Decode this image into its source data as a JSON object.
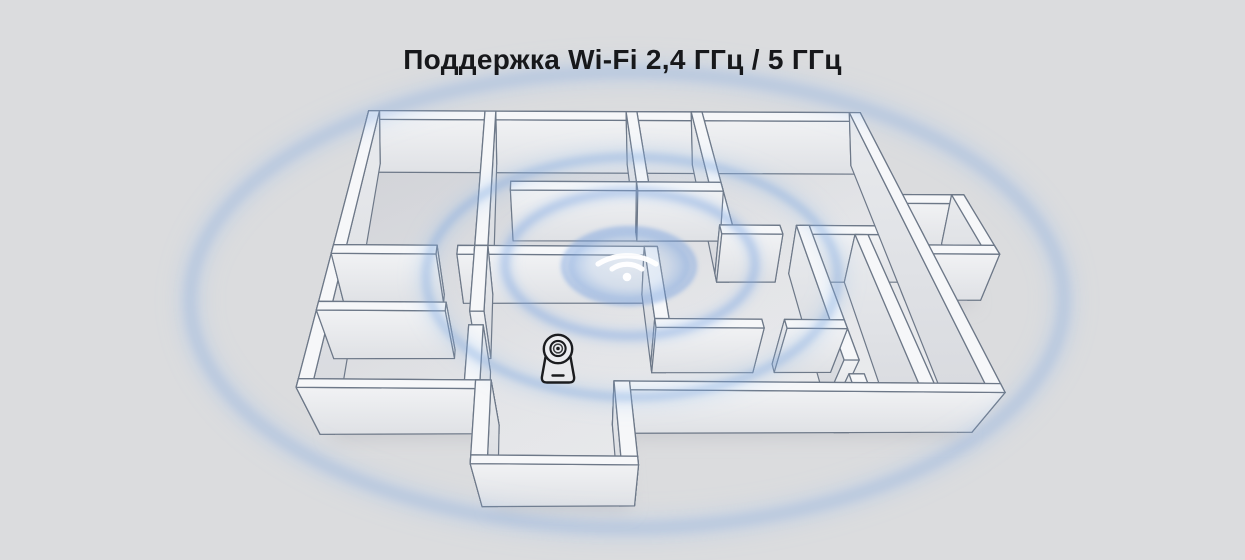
{
  "title": "Поддержка Wi-Fi 2,4 ГГц / 5 ГГц",
  "icons": {
    "wifi": "wifi-icon",
    "camera": "camera-icon"
  },
  "colors": {
    "bg": "#dbdcde",
    "title": "#17181b",
    "wall_stroke": "#6d7888",
    "wall_top": "#f6f7f9",
    "face_hi": "#f1f2f4",
    "face_lo": "#dfe1e5",
    "faced_hi": "#e9ebee",
    "faced_lo": "#d6d8dd",
    "floor_hi": "#e2e3e6",
    "floor_lo": "#eff0f2",
    "shade": "#a9acb5",
    "shadow": "#b9bcc3",
    "signal_core": "#6f9cdd",
    "signal_glow": "#9cc0ec",
    "signal_fill": "#a9c6ec",
    "wifi": "#ffffff",
    "camera": "#1b1c1f"
  }
}
